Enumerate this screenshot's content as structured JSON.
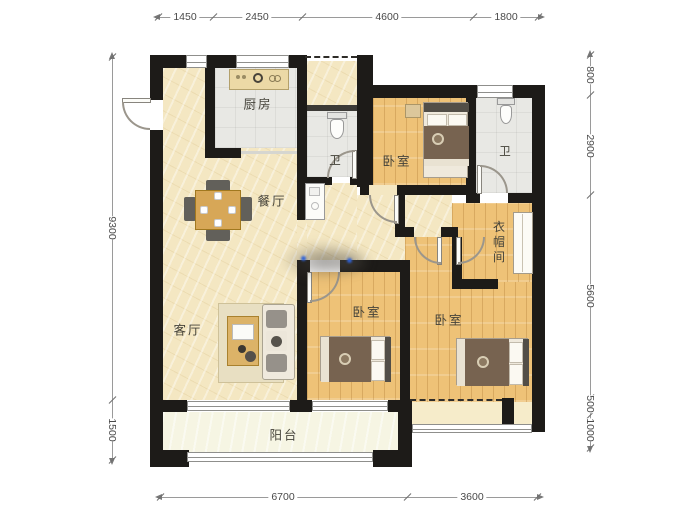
{
  "plan": {
    "rooms": {
      "kitchen": "厨房",
      "bath1": "卫",
      "bath2": "卫",
      "dining": "餐厅",
      "living": "客厅",
      "bedroom_top": "卧室",
      "bedroom_mid": "卧室",
      "bedroom_right": "卧室",
      "cloakroom": "衣帽间",
      "balcony": "阳台"
    },
    "dims": {
      "top": [
        "1450",
        "2450",
        "4600",
        "1800"
      ],
      "bottom": [
        "6700",
        "3600"
      ],
      "left": [
        "9300",
        "1500"
      ],
      "right": [
        "800",
        "2900",
        "5600",
        "500",
        "1000"
      ]
    },
    "colors": {
      "wall": "#1d1b18",
      "floor_main": "#f4e7c2",
      "floor_wood": "#eec277",
      "floor_tile": "#e8e8e4",
      "floor_balcony": "#f6f5e3"
    }
  }
}
